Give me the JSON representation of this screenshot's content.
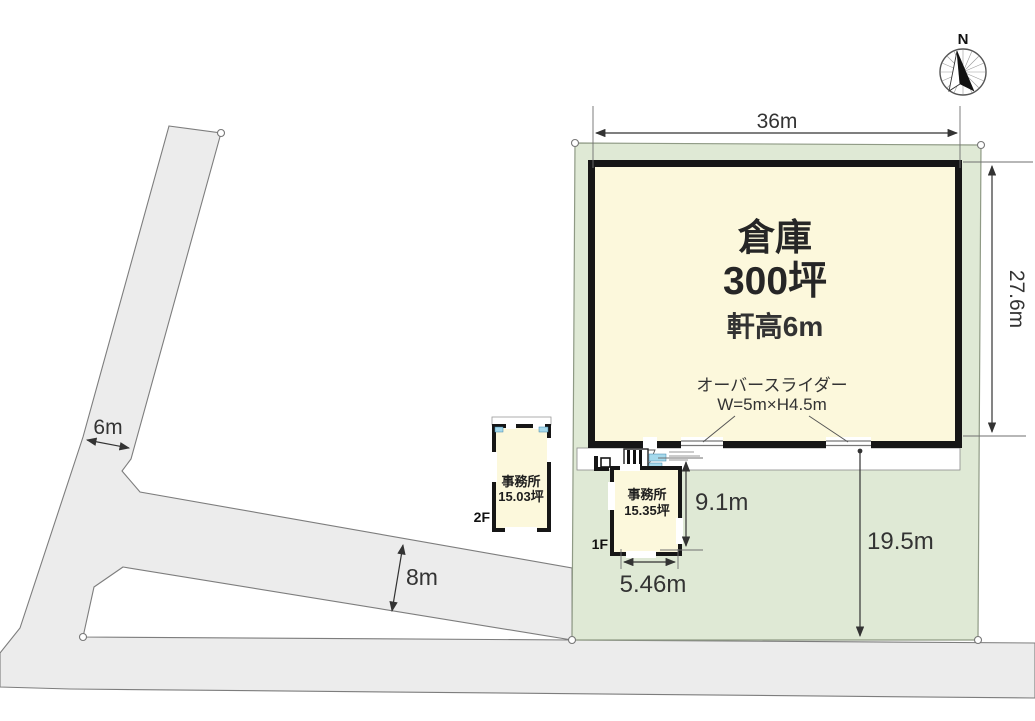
{
  "compass": {
    "north_label": "N"
  },
  "warehouse": {
    "name": "倉庫",
    "area": "300坪",
    "eave_height": "軒高6m",
    "slider_label": "オーバースライダー",
    "slider_size": "W=5m×H4.5m"
  },
  "office_2f": {
    "floor_label": "2F",
    "name": "事務所",
    "area": "15.03坪"
  },
  "office_1f": {
    "floor_label": "1F",
    "name": "事務所",
    "area": "15.35坪"
  },
  "dimensions": {
    "warehouse_width": "36m",
    "warehouse_depth": "27.6m",
    "office_depth": "9.1m",
    "office_width": "5.46m",
    "yard_depth": "19.5m",
    "left_road_width": "6m",
    "bottom_road_width": "8m"
  },
  "colors": {
    "plot_green": "#dfe9d5",
    "road_gray": "#ececec",
    "building_cream": "#fcf8dc",
    "wall_black": "#161616",
    "window_blue": "#a5d9ec",
    "line_gray": "#6f6f6f"
  }
}
